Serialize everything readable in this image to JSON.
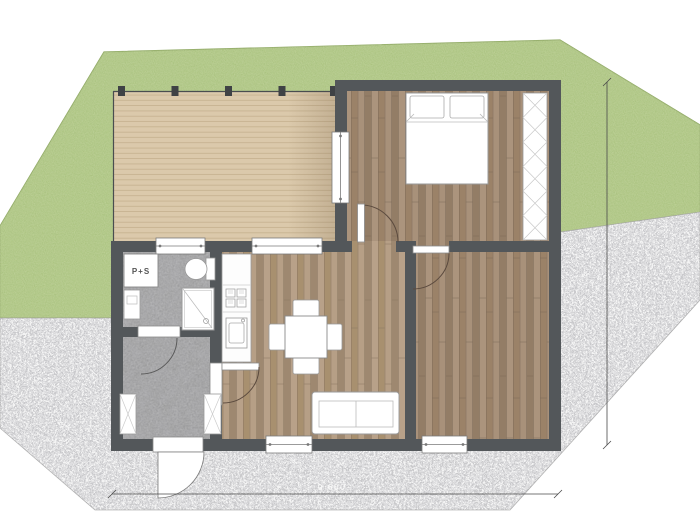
{
  "title": "cottage-floor-plan",
  "labels": {
    "appliance_unit": "P+S",
    "dimension_width": "9 600"
  },
  "site": {
    "areas": [
      "lawn",
      "gravel"
    ],
    "lawn_color": "#a2bd74",
    "gravel_color": "#c6c6c6"
  },
  "plan": {
    "wall_color": "#53575a",
    "deck_color": "#dbc9ab",
    "wood_dark_color": "#a28b73",
    "wood_light_color": "#b0997f",
    "concrete_color": "#949494",
    "rooms": [
      {
        "name": "deck",
        "floor": "wood-deck"
      },
      {
        "name": "bedroom-1",
        "floor": "wood"
      },
      {
        "name": "living-kitchen",
        "floor": "wood"
      },
      {
        "name": "bedroom-2",
        "floor": "wood"
      },
      {
        "name": "bathroom",
        "floor": "concrete"
      },
      {
        "name": "hallway",
        "floor": "concrete"
      }
    ],
    "furniture": [
      "double-bed",
      "wardrobe",
      "sofa",
      "dining-table",
      "chairs-x4",
      "kitchen-counter",
      "cooktop",
      "kitchen-sink",
      "washer-unit-p-plus-s",
      "toilet",
      "shower",
      "bathroom-vanity",
      "hall-closet-left",
      "hall-closet-right"
    ],
    "openings": [
      "entry-door",
      "bedroom-1-door",
      "bedroom-2-door",
      "bathroom-door",
      "living-room-door",
      "window-bath",
      "window-kitchen",
      "window-deck-bedroom",
      "window-living",
      "window-bedroom-2"
    ],
    "dimensions": {
      "bottom_label": "9 600",
      "right_line_present": true
    }
  }
}
